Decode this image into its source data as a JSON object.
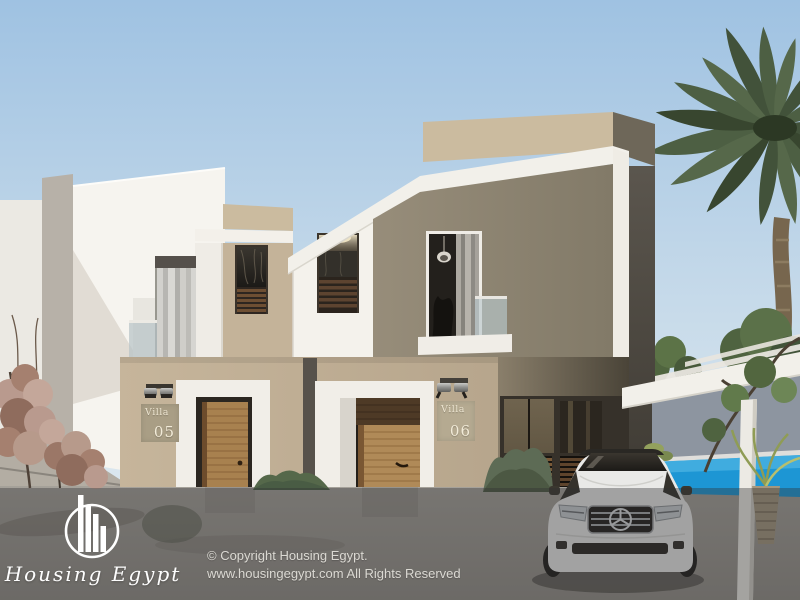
{
  "scene_type": "architectural-exterior-render-two-storey-twin-villas",
  "villas": [
    {
      "label": "Villa",
      "number": "05"
    },
    {
      "label": "Villa",
      "number": "06"
    }
  ],
  "watermark": {
    "brand": "Housing Egypt",
    "copyright_line1": "© Copyright Housing Egypt.",
    "copyright_line2": "www.housingegypt.com All Rights Reserved"
  },
  "icons": {
    "logo": "housing-egypt-skyline-circle-logo",
    "car_badge": "mercedes-three-pointed-star"
  },
  "colors": {
    "sky_top": "#9fc2e2",
    "sky_horizon": "#dde8ef",
    "white_wall": "#f4f2ec",
    "beige_light": "#cbbb9f",
    "beige_wall": "#c4b399",
    "beige_dark": "#8e8573",
    "shadow_side": "#55504a",
    "wood_door": "#ac8554",
    "louvre_wood": "#6b4e33",
    "pool_water": "#1d96d4",
    "pool_back_wall": "#8d95a0",
    "pergola_white": "#f2f0ea",
    "road": "#a7a39c",
    "palm_green": "#4b5d40",
    "hedge_green": "#55684a",
    "dry_tree_pink": "#b7988e",
    "car_body": "#e9e9e7",
    "watermark_overlay": "rgba(48,48,50,0.38)",
    "logo_white": "#ffffff"
  }
}
